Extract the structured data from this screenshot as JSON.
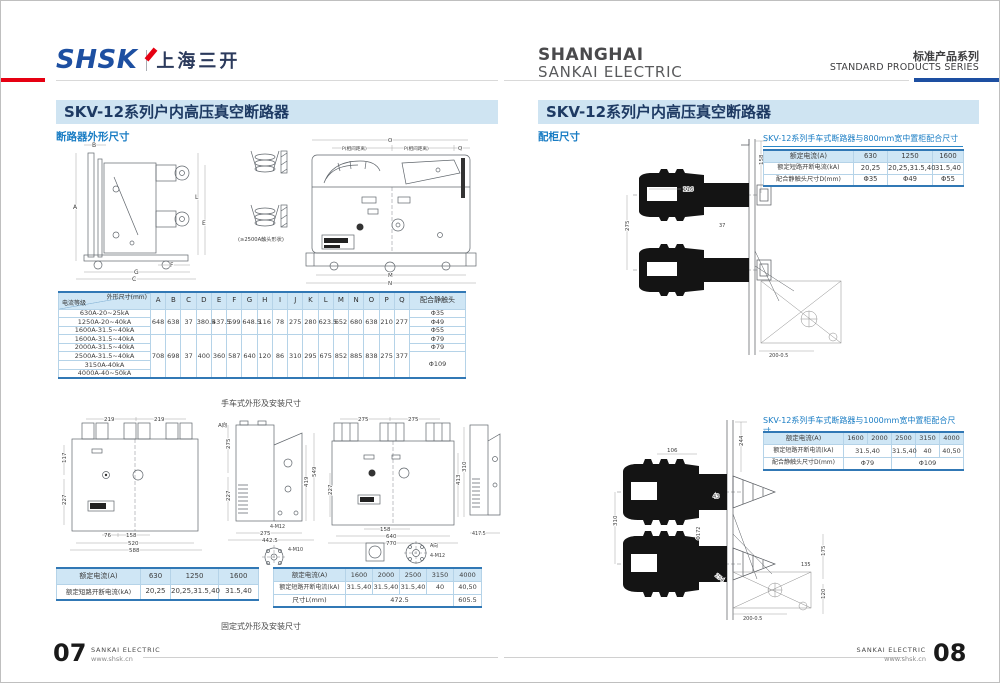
{
  "colors": {
    "accent_red": "#e60012",
    "brand_blue": "#1d4fa1",
    "section_blue": "#1a7dc4",
    "table_header_bg": "#cfe6f5",
    "title_bar_bg": "#cfe4f2"
  },
  "header": {
    "brand": "SHSK",
    "brand_cn": "上海三开",
    "company_line1": "SHANGHAI",
    "company_line2": "SANKAI ELECTRIC",
    "series_cn": "标准产品系列",
    "series_en": "STANDARD PRODUCTS SERIES"
  },
  "left_page": {
    "title": "SKV-12系列户内高压真空断路器",
    "section_label": "断路器外形尺寸",
    "caption_handcart": "手车式外形及安装尺寸",
    "caption_fixed": "固定式外形及安装尺寸",
    "dim_table": {
      "corner_top": "外形尺寸(mm)",
      "corner_bottom": "电流等级",
      "columns": [
        "A",
        "B",
        "C",
        "D",
        "E",
        "F",
        "G",
        "H",
        "I",
        "J",
        "K",
        "L",
        "M",
        "N",
        "O",
        "P",
        "Q"
      ],
      "contact_header": "配合静触头",
      "row_labels": [
        "630A-20~25kA",
        "1250A-20~40kA",
        "1600A-31.5~40kA",
        "1600A-31.5~40kA",
        "2000A-31.5~40kA",
        "2500A-31.5~40kA",
        "3150A-40kA",
        "4000A-40~50kA"
      ],
      "group1": [
        "648",
        "638",
        "37",
        "380.5",
        "437.5",
        "599",
        "648.5",
        "116",
        "78",
        "275",
        "280",
        "623.5",
        "652",
        "680",
        "638",
        "210",
        "277"
      ],
      "group2": [
        "708",
        "698",
        "37",
        "400",
        "360",
        "587",
        "640",
        "120",
        "86",
        "310",
        "295",
        "675",
        "852",
        "885",
        "838",
        "275",
        "377"
      ],
      "contacts": [
        "Φ35",
        "Φ49",
        "Φ55",
        "Φ79",
        "Φ79",
        "Φ109"
      ]
    },
    "table_a": {
      "r1_label": "额定电流(A)",
      "r1": [
        "630",
        "1250",
        "1600"
      ],
      "r2_label": "额定短路开断电流(kA)",
      "r2": [
        "20,25",
        "20,25,31.5,40",
        "31.5,40"
      ]
    },
    "table_b": {
      "r1_label": "额定电流(A)",
      "r1": [
        "1600",
        "2000",
        "2500",
        "3150",
        "4000"
      ],
      "r2_label": "额定短路开断电流(kA)",
      "r2": [
        "31.5,40",
        "31.5,40",
        "31.5,40",
        "40",
        "40,50"
      ],
      "r3_label": "尺寸L(mm)",
      "r3_merged": "472.5",
      "r3_last": "605.5"
    }
  },
  "right_page": {
    "title": "SKV-12系列户内高压真空断路器",
    "section_label": "配柜尺寸",
    "table1": {
      "title": "SKV-12系列手车式断路器与800mm宽中置柜配合尺寸",
      "r1_label": "额定电流(A)",
      "r1": [
        "630",
        "1250",
        "1600"
      ],
      "r2_label": "额定短路开断电流(kA)",
      "r2": [
        "20,25",
        "20,25,31.5,40",
        "31.5,40"
      ],
      "r3_label": "配合静触头尺寸D(mm)",
      "r3": [
        "Φ35",
        "Φ49",
        "Φ55"
      ]
    },
    "table2": {
      "title": "SKV-12系列手车式断路器与1000mm宽中置柜配合尺寸",
      "r1_label": "额定电流(A)",
      "r1": [
        "1600",
        "2000",
        "2500",
        "3150",
        "4000"
      ],
      "r2_label": "额定短路开断电流(kA)",
      "r2_m1": "31.5,40",
      "r2": [
        "31.5,40",
        "40",
        "40,50"
      ],
      "r3_label": "配合静触头尺寸D(mm)",
      "r3_m1": "Φ79",
      "r3_m2": "Φ109"
    }
  },
  "footer": {
    "left_no": "07",
    "right_no": "08",
    "brand": "SANKAI ELECTRIC",
    "url": "www.shsk.cn"
  },
  "drawings": {
    "handcart": {
      "A": "A",
      "B": "B",
      "C": "C",
      "F": "F",
      "G": "G",
      "L": "L",
      "E": "E",
      "O": "O",
      "P1": "P(相间距离)",
      "P2": "P(相间距离)",
      "Q": "Q",
      "M": "M",
      "N": "N",
      "note": "(≥2500A触头形状)"
    },
    "fixed": {
      "t1": "219",
      "t2": "219",
      "l1": "117",
      "l2": "227",
      "b0": "76",
      "b1": "158",
      "b2": "520",
      "b3": "588",
      "sl1": "275",
      "sl2": "227",
      "sr1": "419",
      "sr2": "549",
      "sn1": "4-M12",
      "sb1": "275",
      "sb2": "442.5",
      "dn1": "A向",
      "dn2": "4-M10",
      "t3": "275",
      "t4": "275",
      "l3": "227",
      "r3": "413",
      "gb1": "158",
      "gb2": "640",
      "gb3": "770",
      "g2l": "310",
      "g2b": "417.5",
      "dn3": "A向",
      "dn4": "4-M12"
    },
    "cab1": {
      "c158": "158",
      "c275": "275",
      "c116": "116",
      "c37": "37",
      "c200": "200-0.5"
    },
    "cab2": {
      "d244": "244",
      "d106": "106",
      "d43": "43",
      "d310": "310",
      "d172": "Φ172",
      "d254": "254",
      "d175": "175",
      "d120": "120",
      "d135": "135",
      "d200": "200-0.5"
    }
  }
}
